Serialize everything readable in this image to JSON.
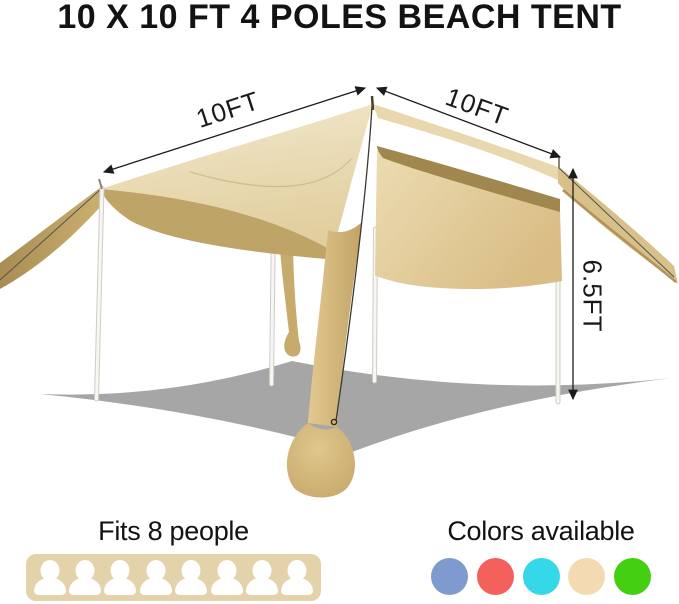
{
  "title": "10 X 10 FT 4 POLES BEACH TENT",
  "dimensions": {
    "left_width": "10FT",
    "right_depth": "10FT",
    "height": "6.5FT"
  },
  "capacity": {
    "label": "Fits 8 people",
    "count": 8,
    "box_color": "#e4d2aa"
  },
  "colors_available": {
    "label": "Colors available",
    "swatches": [
      {
        "name": "blue",
        "hex": "#7f9ace"
      },
      {
        "name": "coral",
        "hex": "#f4615c"
      },
      {
        "name": "cyan",
        "hex": "#35d8e8"
      },
      {
        "name": "beige",
        "hex": "#f3dab2"
      },
      {
        "name": "green",
        "hex": "#45cf12"
      }
    ]
  },
  "tent": {
    "fabric_color": "#e6d4a6",
    "shadow_color": "#a6a6a6"
  }
}
